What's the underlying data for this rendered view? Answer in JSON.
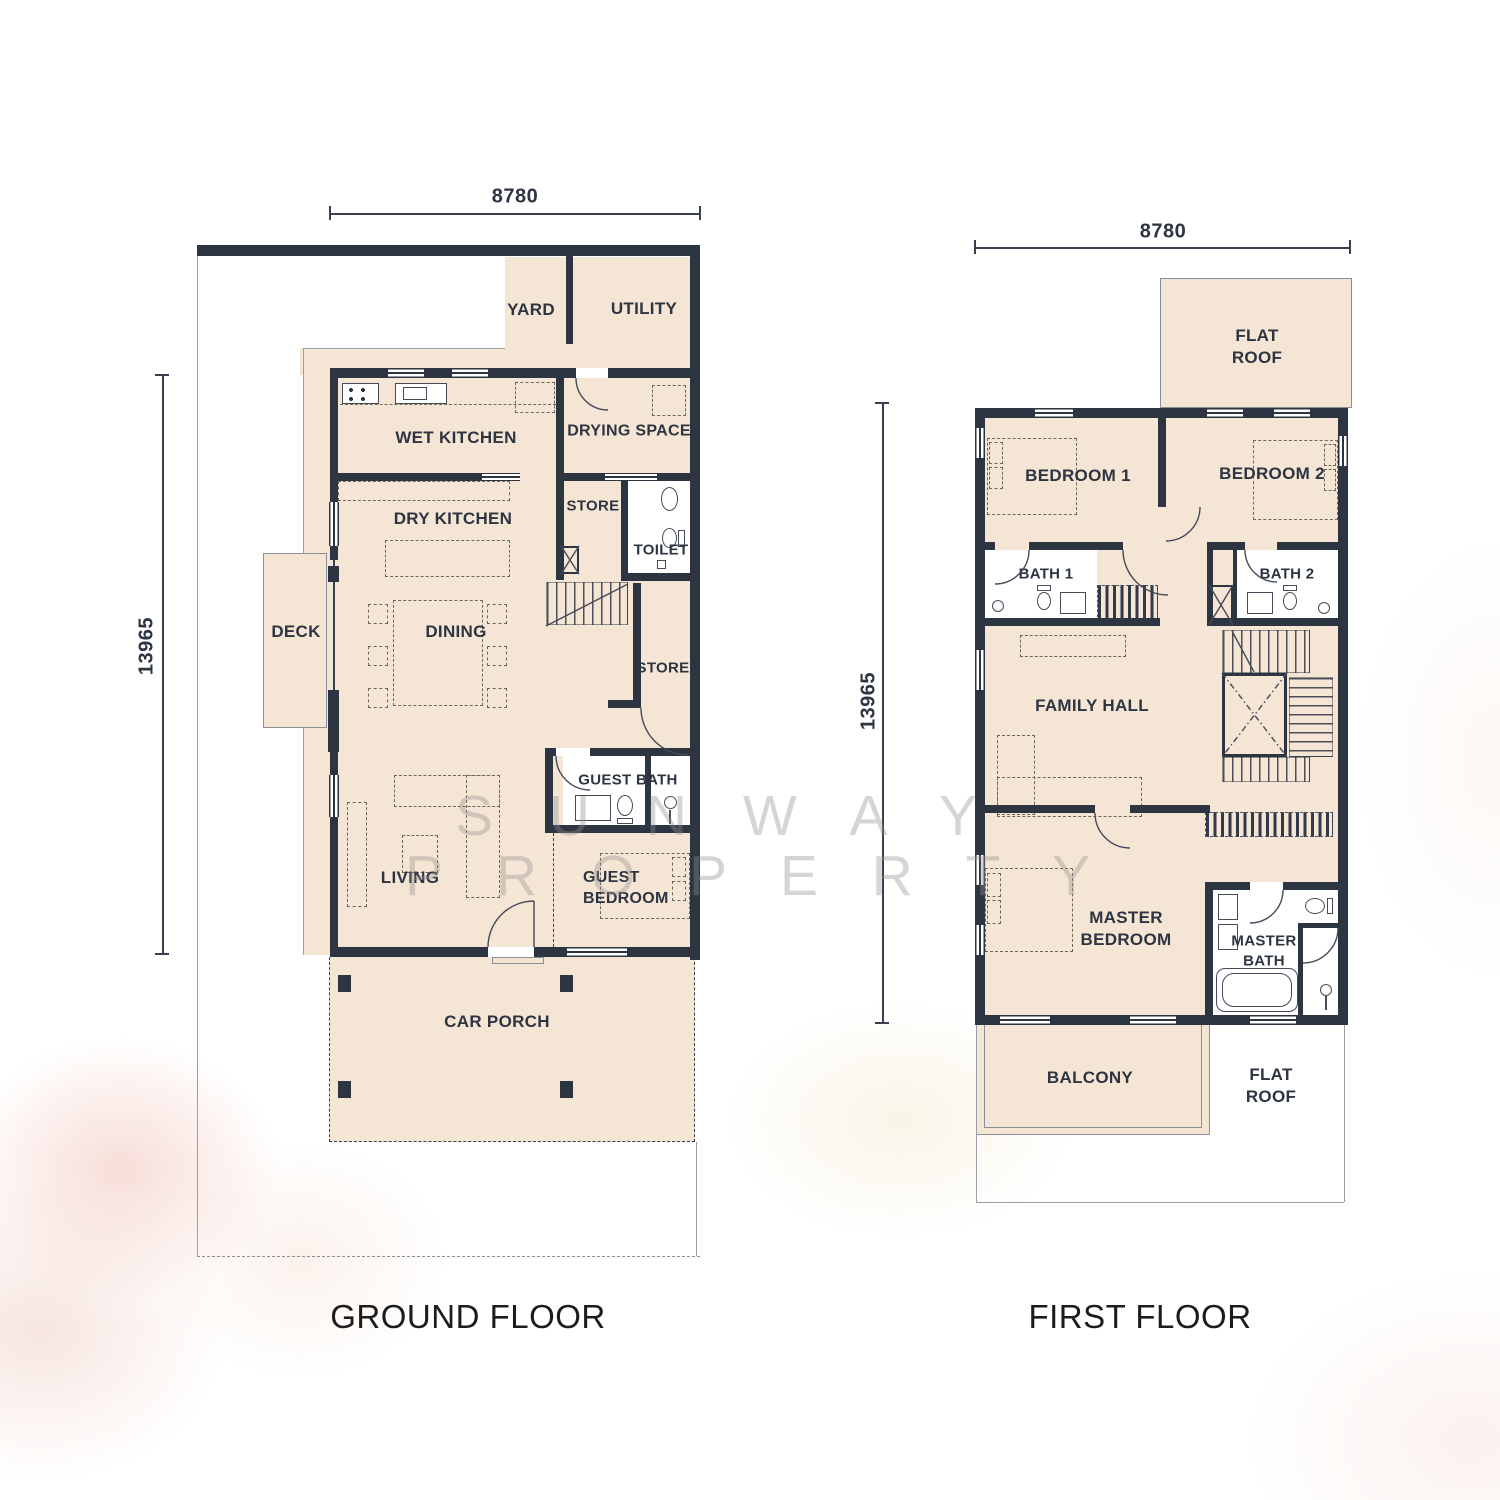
{
  "titles": {
    "ground": "GROUND FLOOR",
    "first": "FIRST FLOOR"
  },
  "dims": {
    "width": "8780",
    "height": "13965"
  },
  "watermark": {
    "row1": "S U N W A Y",
    "row2": "P R O P E R T Y"
  },
  "ground_rooms": {
    "yard": "YARD",
    "utility": "UTILITY",
    "wet_kitchen": "WET KITCHEN",
    "drying_space": "DRYING SPACE",
    "dry_kitchen": "DRY KITCHEN",
    "store_upper": "STORE",
    "toilet": "TOILET",
    "deck": "DECK",
    "dining": "DINING",
    "store_lower": "STORE",
    "guest_bath": "GUEST BATH",
    "living": "LIVING",
    "guest_bedroom": "GUEST\nBEDROOM",
    "car_porch": "CAR PORCH"
  },
  "first_rooms": {
    "flat_roof_top": "FLAT\nROOF",
    "bedroom1": "BEDROOM 1",
    "bedroom2": "BEDROOM 2",
    "bath1": "BATH 1",
    "bath2": "BATH 2",
    "family_hall": "FAMILY HALL",
    "master_bedroom": "MASTER\nBEDROOM",
    "master_bath": "MASTER\nBATH",
    "balcony": "BALCONY",
    "flat_roof_bottom": "FLAT\nROOF"
  }
}
